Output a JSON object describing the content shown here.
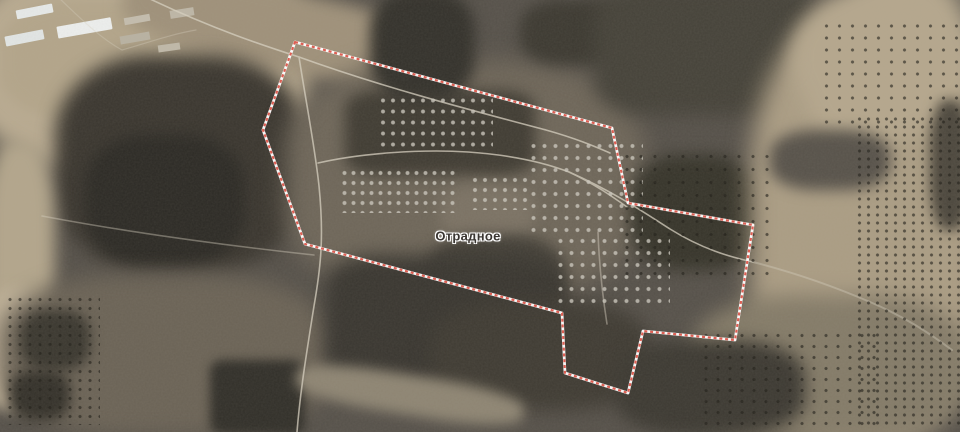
{
  "map": {
    "type": "satellite",
    "place_label": "Отрадное",
    "label": {
      "x": 468,
      "y": 236,
      "color": "#3a3632",
      "halo_color": "#ffffff",
      "font_size_px": 13
    },
    "boundary": {
      "name": "settlement-boundary",
      "stroke_color": "#db564a",
      "casing_color": "#ffffff",
      "stroke_width_px": 2.2,
      "casing_width_px": 2.8,
      "dash_pattern_px": [
        3,
        2.8
      ],
      "points": [
        [
          295,
          42
        ],
        [
          612,
          128
        ],
        [
          628,
          203
        ],
        [
          753,
          225
        ],
        [
          735,
          340
        ],
        [
          643,
          331
        ],
        [
          628,
          393
        ],
        [
          565,
          373
        ],
        [
          562,
          313
        ],
        [
          305,
          244
        ],
        [
          263,
          130
        ]
      ]
    },
    "imagery_palette": {
      "dark_field": "#35322b",
      "mid_field": "#6b6357",
      "light_terrain": "#ac9e85",
      "road": "#d8d1c1",
      "forest": "#33312a",
      "farm_roof": "#e9ebea"
    }
  }
}
